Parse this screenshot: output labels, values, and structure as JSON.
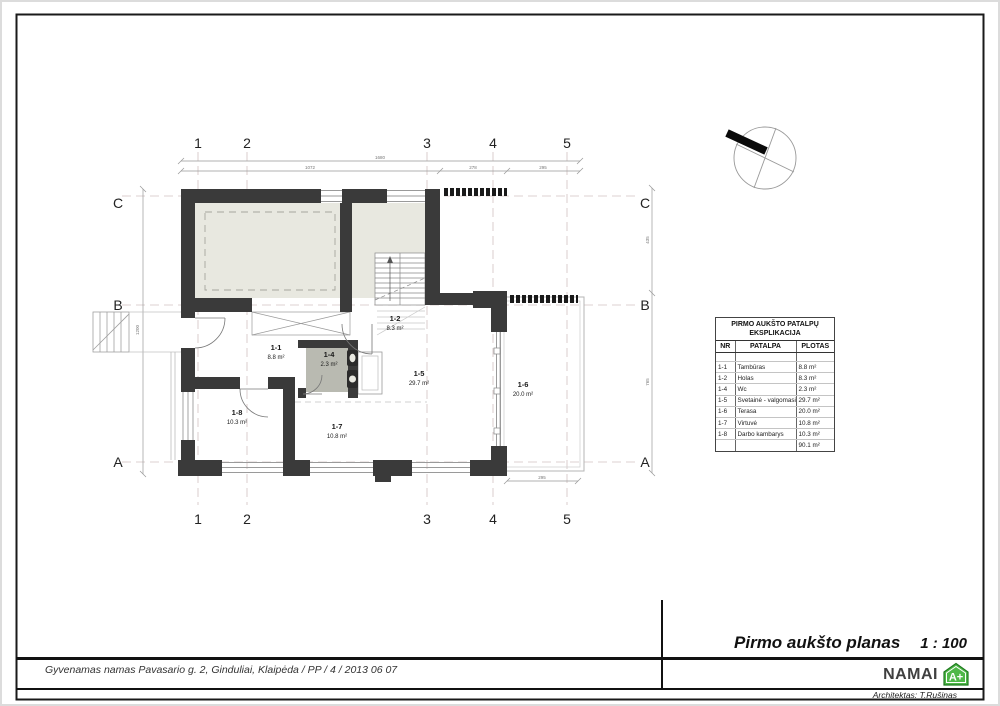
{
  "sheet": {
    "title": "Pirmo aukšto planas",
    "scale": "1 : 100",
    "project_info": "Gyvenamas namas Pavasario g. 2, Ginduliai, Klaipėda / PP / 4 / 2013 06 07",
    "brand": "NAMAI",
    "brand_badge": "A+",
    "architect": "Architektas: T.Rušinas"
  },
  "grid": {
    "cols": [
      "1",
      "2",
      "3",
      "4",
      "5"
    ],
    "rows": [
      "C",
      "B",
      "A"
    ]
  },
  "dimensions": {
    "top_total": "1680",
    "top_segments": [
      "1072",
      "278",
      "295"
    ],
    "left_total": "1200",
    "right_segments": [
      "435",
      "765"
    ],
    "bottom_terrace": "295"
  },
  "rooms": [
    {
      "id": "1-1",
      "area": "8.8 m²"
    },
    {
      "id": "1-2",
      "area": "8.3 m²"
    },
    {
      "id": "1-4",
      "area": "2.3 m²"
    },
    {
      "id": "1-5",
      "area": "29.7 m²"
    },
    {
      "id": "1-6",
      "area": "20.0 m²"
    },
    {
      "id": "1-7",
      "area": "10.8 m²"
    },
    {
      "id": "1-8",
      "area": "10.3 m²"
    }
  ],
  "legend_table": {
    "title_line1": "PIRMO AUKŠTO PATALPŲ",
    "title_line2": "EKSPLIKACIJA",
    "headers": [
      "NR",
      "PATALPA",
      "PLOTAS"
    ],
    "rows": [
      {
        "nr": "1-1",
        "name": "Tambūras",
        "area": "8.8 m²"
      },
      {
        "nr": "1-2",
        "name": "Holas",
        "area": "8.3 m²"
      },
      {
        "nr": "1-4",
        "name": "Wc",
        "area": "2.3 m²"
      },
      {
        "nr": "1-5",
        "name": "Svetainė - valgomasis",
        "area": "29.7 m²"
      },
      {
        "nr": "1-6",
        "name": "Terasa",
        "area": "20.0 m²"
      },
      {
        "nr": "1-7",
        "name": "Virtuvė",
        "area": "10.8 m²"
      },
      {
        "nr": "1-8",
        "name": "Darbo kambarys",
        "area": "10.3 m²"
      }
    ],
    "total_area": "90.1 m²"
  },
  "colors": {
    "wall": "#3a3a3a",
    "room_fill": "#e8e8e0",
    "wc_fill": "#b9bab1",
    "brand_green": "#4fb848"
  }
}
